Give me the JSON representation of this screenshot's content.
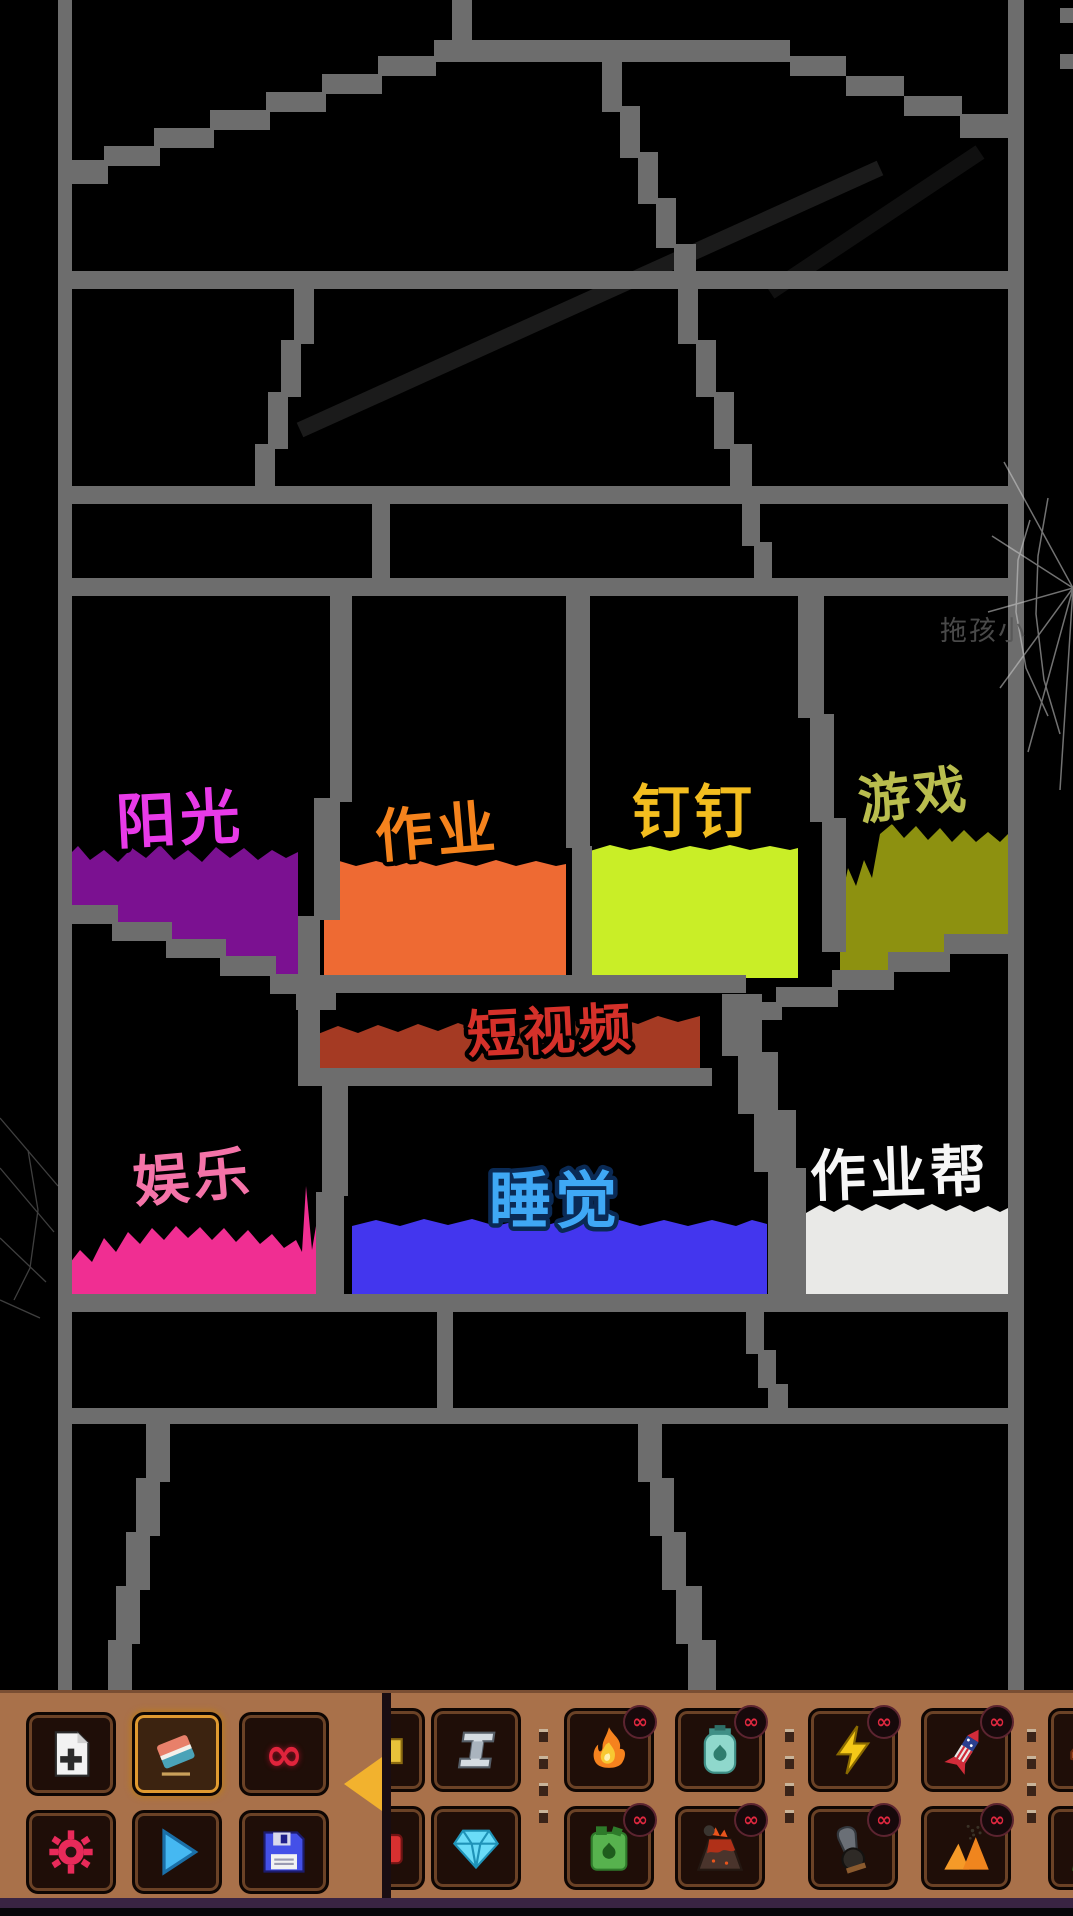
{
  "scene": {
    "watermark": "拖孩小",
    "colors": {
      "background": "#000000",
      "frame_gray": "#6d6d6d",
      "cobweb": "#d8d8d8"
    },
    "pools": [
      {
        "id": "sunshine",
        "label": "阳光",
        "label_color": "#e83ae8",
        "pool_color": "#7b1191"
      },
      {
        "id": "homework",
        "label": "作业",
        "label_color": "#f5831d",
        "pool_color": "#ee6a33"
      },
      {
        "id": "dingtalk",
        "label": "钉钉",
        "label_color": "#f3bd1f",
        "pool_color": "#c9ee27"
      },
      {
        "id": "game",
        "label": "游戏",
        "label_color": "#b9bd4e",
        "pool_color": "#8d9110"
      },
      {
        "id": "short-video",
        "label": "短视频",
        "label_color": "#d5312a",
        "pool_color": "#a53a23"
      },
      {
        "id": "entertainment",
        "label": "娱乐",
        "label_color": "#f473a8",
        "pool_color": "#f02e92"
      },
      {
        "id": "sleep",
        "label": "睡觉",
        "label_color": "#3fa8f5",
        "pool_color": "#4336ee"
      },
      {
        "id": "homework-help",
        "label": "作业帮",
        "label_color": "#f6f6f6",
        "pool_color": "#e9e9e7"
      }
    ]
  },
  "toolbar": {
    "background_color": "#a9714a",
    "active_border_color": "#e09a30",
    "arrow_color": "#f2b22e",
    "badge_color": "#e02840",
    "infinity_glyph": "∞",
    "tools": [
      {
        "id": "new-file",
        "active": false
      },
      {
        "id": "eraser",
        "active": true
      },
      {
        "id": "infinity",
        "active": false,
        "glyph": "∞"
      },
      {
        "id": "settings",
        "active": false
      },
      {
        "id": "play",
        "active": false
      },
      {
        "id": "save",
        "active": false
      }
    ],
    "elements": [
      {
        "id": "steel",
        "infinite": false
      },
      {
        "id": "diamond",
        "infinite": false
      },
      {
        "id": "fire",
        "infinite": true
      },
      {
        "id": "fuel-can",
        "infinite": true
      },
      {
        "id": "gas-tank",
        "infinite": true
      },
      {
        "id": "volcano",
        "infinite": true
      },
      {
        "id": "lightning",
        "infinite": true
      },
      {
        "id": "cannon",
        "infinite": true
      },
      {
        "id": "firework",
        "infinite": true
      },
      {
        "id": "sand-eruption",
        "infinite": true
      }
    ]
  }
}
